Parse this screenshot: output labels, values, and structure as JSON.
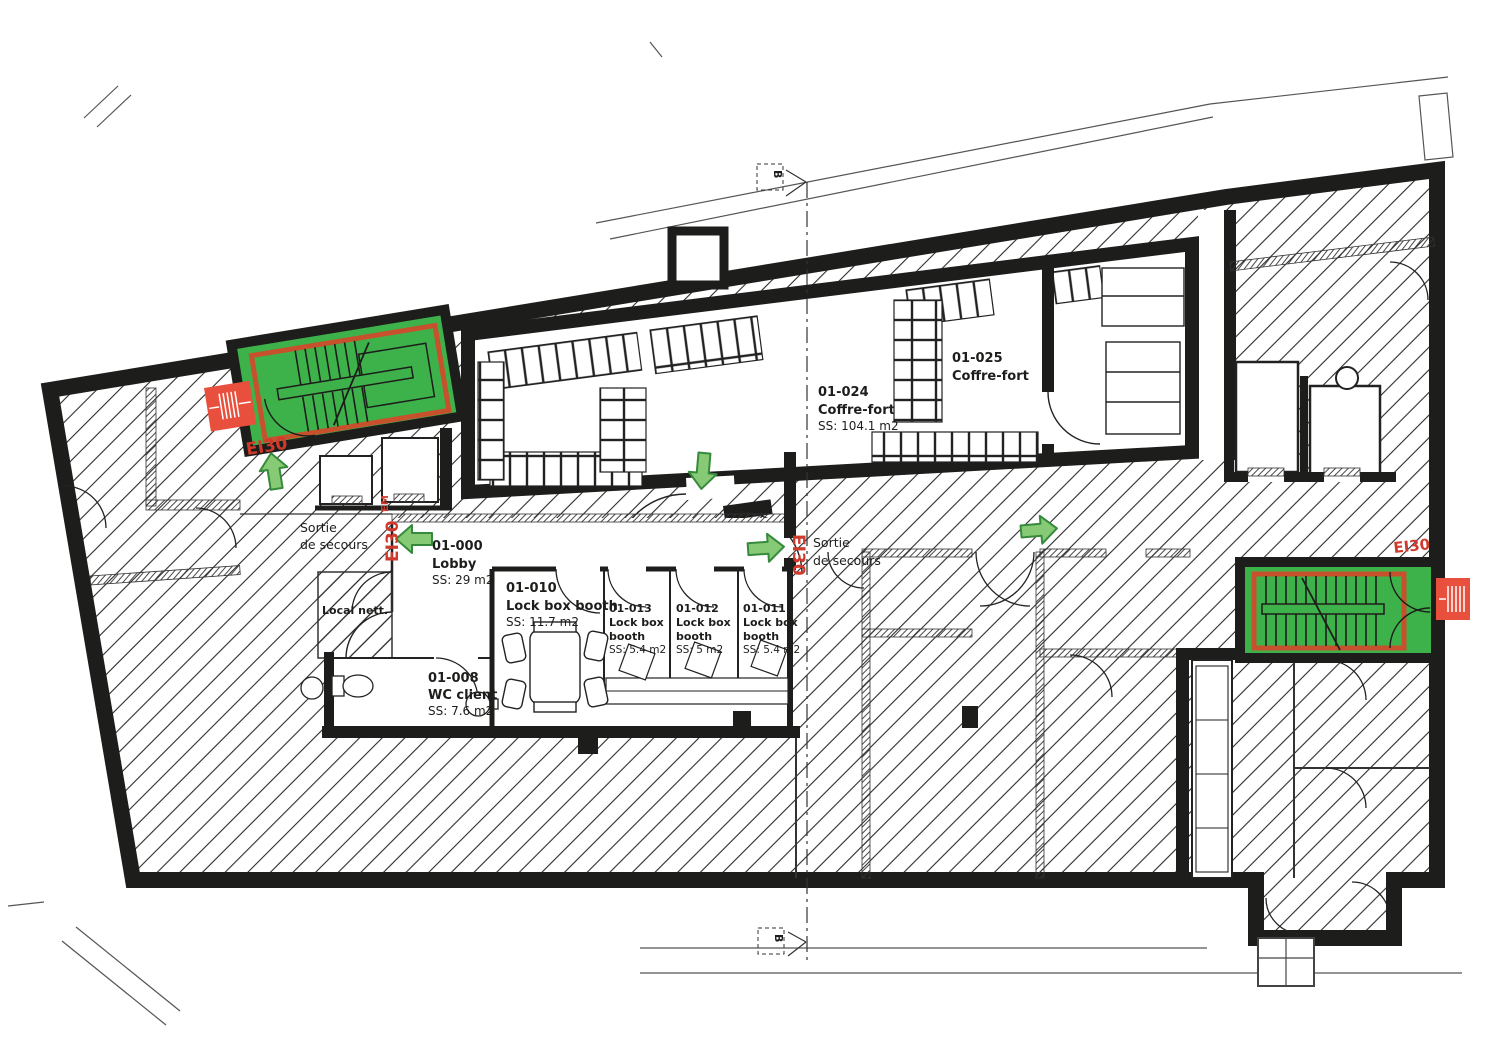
{
  "rooms": [
    {
      "id": "01-024",
      "name": "Coffre-fort",
      "area": "SS: 104.1 m2"
    },
    {
      "id": "01-025",
      "name": "Coffre-fort"
    },
    {
      "id": "01-000",
      "name": "Lobby",
      "area": "SS: 29 m2"
    },
    {
      "id": "01-010",
      "name": "Lock box booth",
      "area": "SS: 11.7 m2"
    },
    {
      "id": "01-013",
      "name_l1": "Lock box",
      "name_l2": "booth",
      "area": "SS: 5.4 m2"
    },
    {
      "id": "01-012",
      "name_l1": "Lock box",
      "name_l2": "booth",
      "area": "SS: 5 m2"
    },
    {
      "id": "01-011",
      "name_l1": "Lock box",
      "name_l2": "booth",
      "area": "SS: 5.4 m2"
    },
    {
      "id": "01-008",
      "name": "WC client",
      "area": "SS: 7.6 m2"
    },
    {
      "name": "Local nett."
    }
  ],
  "annotations": {
    "exit_l1": "Sortie",
    "exit_l2": "de secours",
    "fire_rating": "EI30",
    "fire_rating_suffix": "EM",
    "section_marker": "B"
  },
  "colors": {
    "wall": "#1d1d1b",
    "stair_green": "#3eb24a",
    "escape_route_red": "#c6512c",
    "fire_equipment_red": "#e94f3d",
    "arrow_green": "#87ca76",
    "label_red": "#cf3a2c"
  }
}
